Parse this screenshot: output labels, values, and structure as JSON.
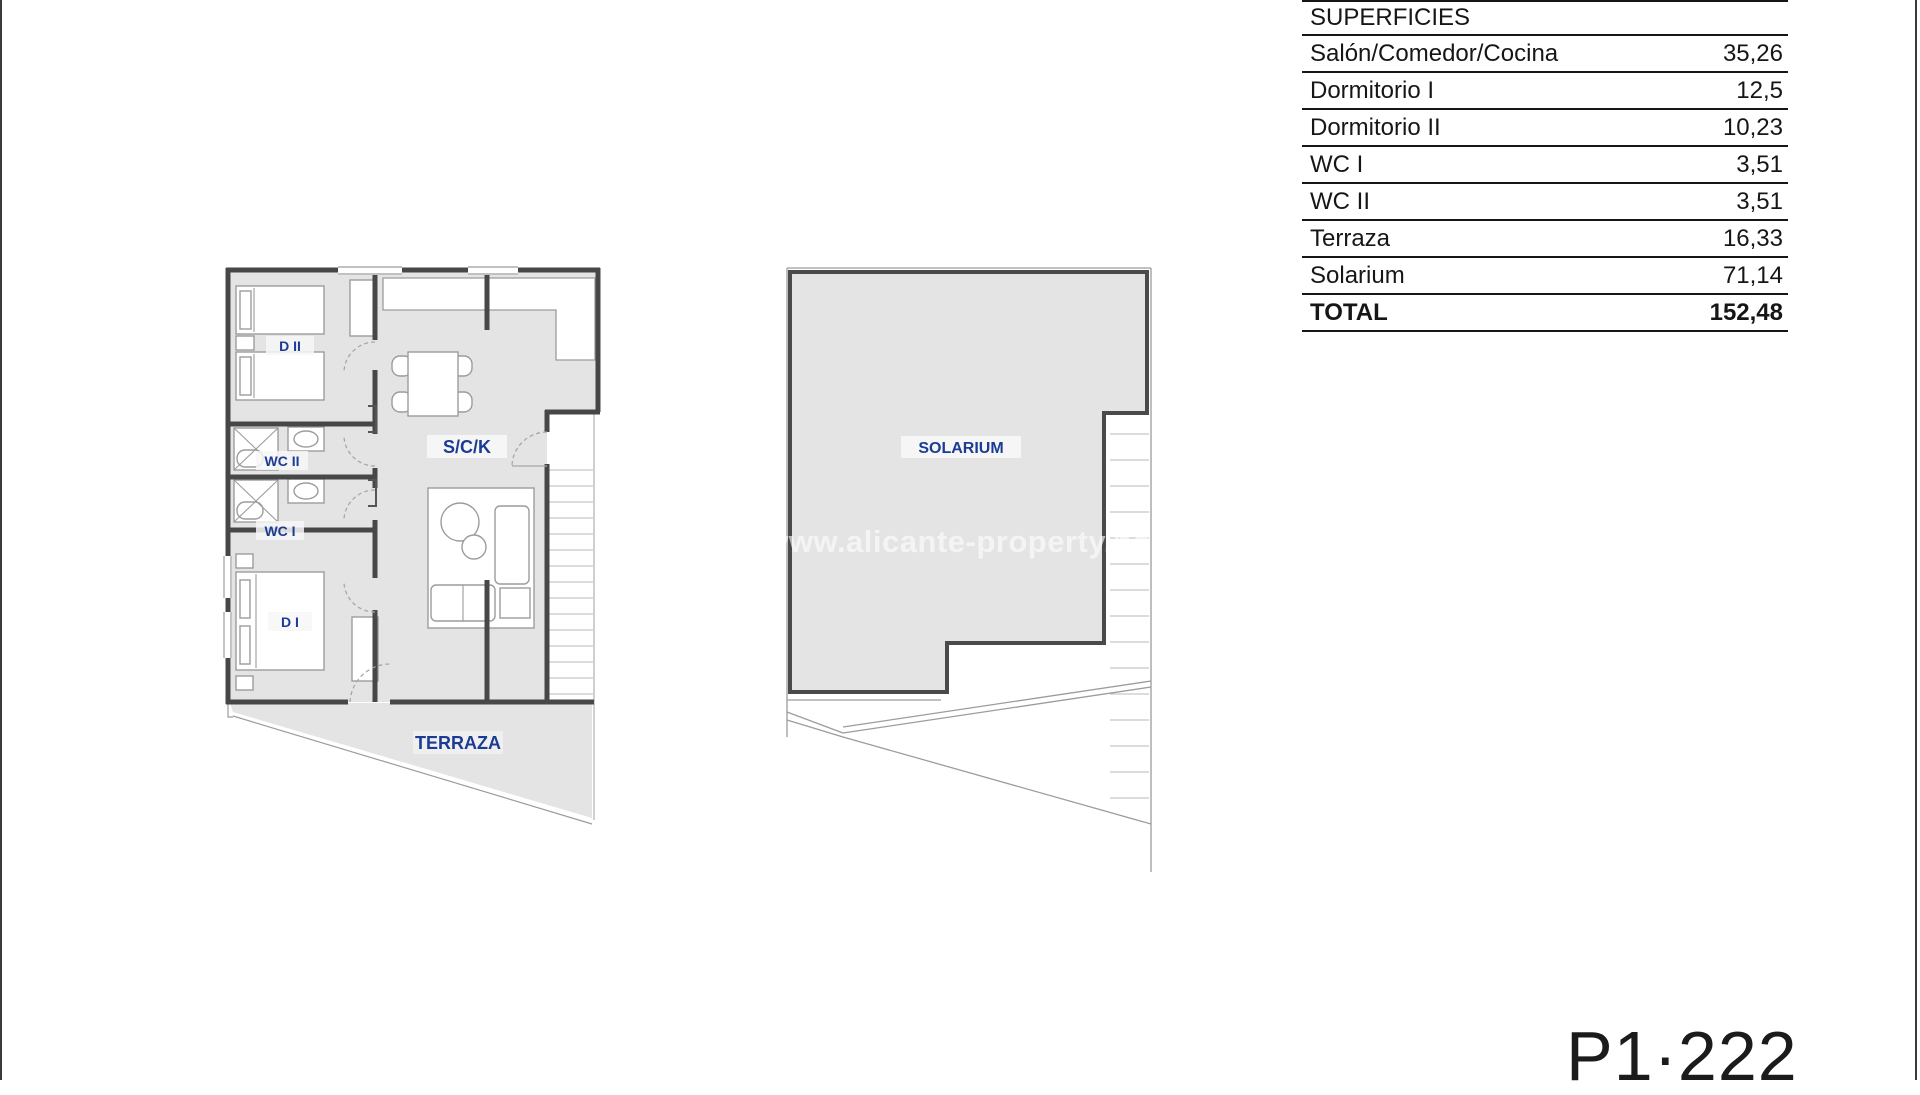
{
  "table": {
    "title": "SUPERFICIES",
    "rows": [
      {
        "label": "Salón/Comedor/Cocina",
        "value": "35,26"
      },
      {
        "label": "Dormitorio I",
        "value": "12,5"
      },
      {
        "label": "Dormitorio II",
        "value": "10,23"
      },
      {
        "label": "WC I",
        "value": "3,51"
      },
      {
        "label": "WC II",
        "value": "3,51"
      },
      {
        "label": "Terraza",
        "value": "16,33"
      },
      {
        "label": "Solarium",
        "value": "71,14"
      }
    ],
    "total": {
      "label": "TOTAL",
      "value": "152,48"
    }
  },
  "floorplan": {
    "rooms": {
      "d2": "D II",
      "wc2": "WC II",
      "wc1": "WC I",
      "d1": "D I",
      "sck": "S/C/K",
      "terraza": "TERRAZA",
      "solarium": "SOLARIUM"
    },
    "watermark": "www.alicante-property.no"
  },
  "sheet": {
    "code": "P1·222"
  },
  "colors": {
    "label_blue": "#1c3c94",
    "floor_gray": "#e4e4e4",
    "wall_dark": "#474747",
    "line_black": "#161616"
  }
}
